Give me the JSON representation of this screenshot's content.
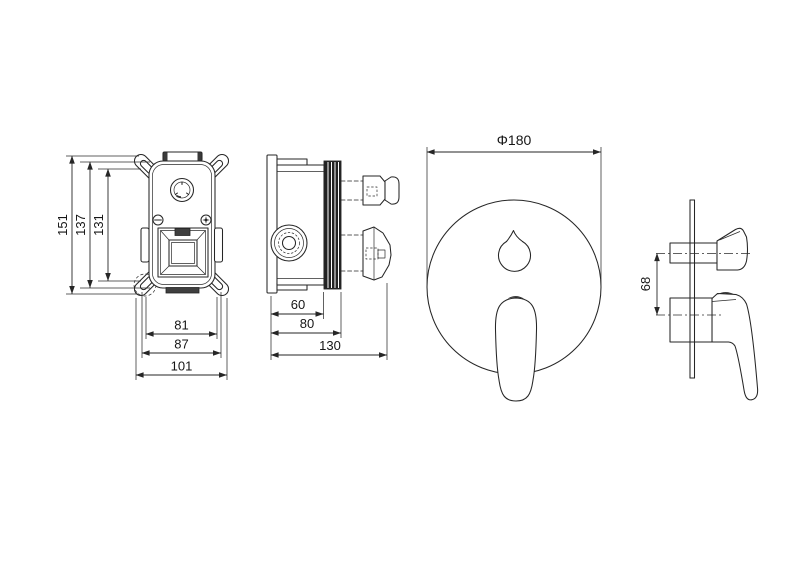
{
  "drawing": {
    "background": "#ffffff",
    "line_color": "#262626",
    "views": {
      "valve_front": {
        "dims": {
          "overall_height": "151",
          "body_height": "137",
          "mounting_height": "131",
          "inner_width": "81",
          "body_width": "87",
          "overall_width": "101"
        }
      },
      "valve_side": {
        "dims": {
          "depth_front": "60",
          "depth_mid": "80",
          "overall_depth": "130"
        }
      },
      "trim_front": {
        "dims": {
          "plate_diameter": "Φ180"
        }
      },
      "trim_side": {
        "dims": {
          "handle_center_distance": "68"
        }
      }
    }
  }
}
